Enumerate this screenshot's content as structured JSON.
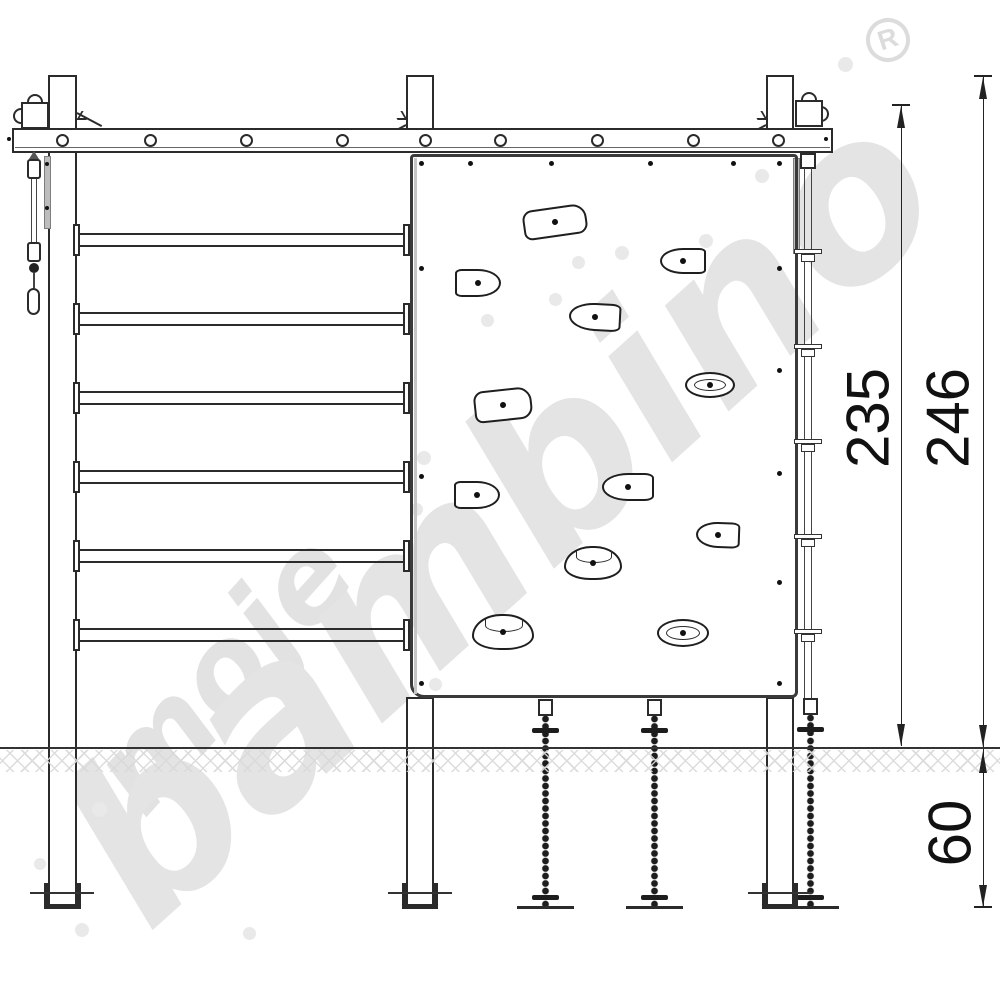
{
  "registered_mark": "R",
  "watermark": {
    "line1": "moje",
    "line2": "bambino"
  },
  "dimensions": {
    "above_ground_frame": {
      "label": "235"
    },
    "above_ground_total": {
      "label": "246"
    },
    "below_ground": {
      "label": "60"
    }
  },
  "colors": {
    "line": "#2b2b2b",
    "watermark": "#e4e4e4",
    "hatch": "#d9d9d9",
    "dimension_text": "#111111"
  }
}
